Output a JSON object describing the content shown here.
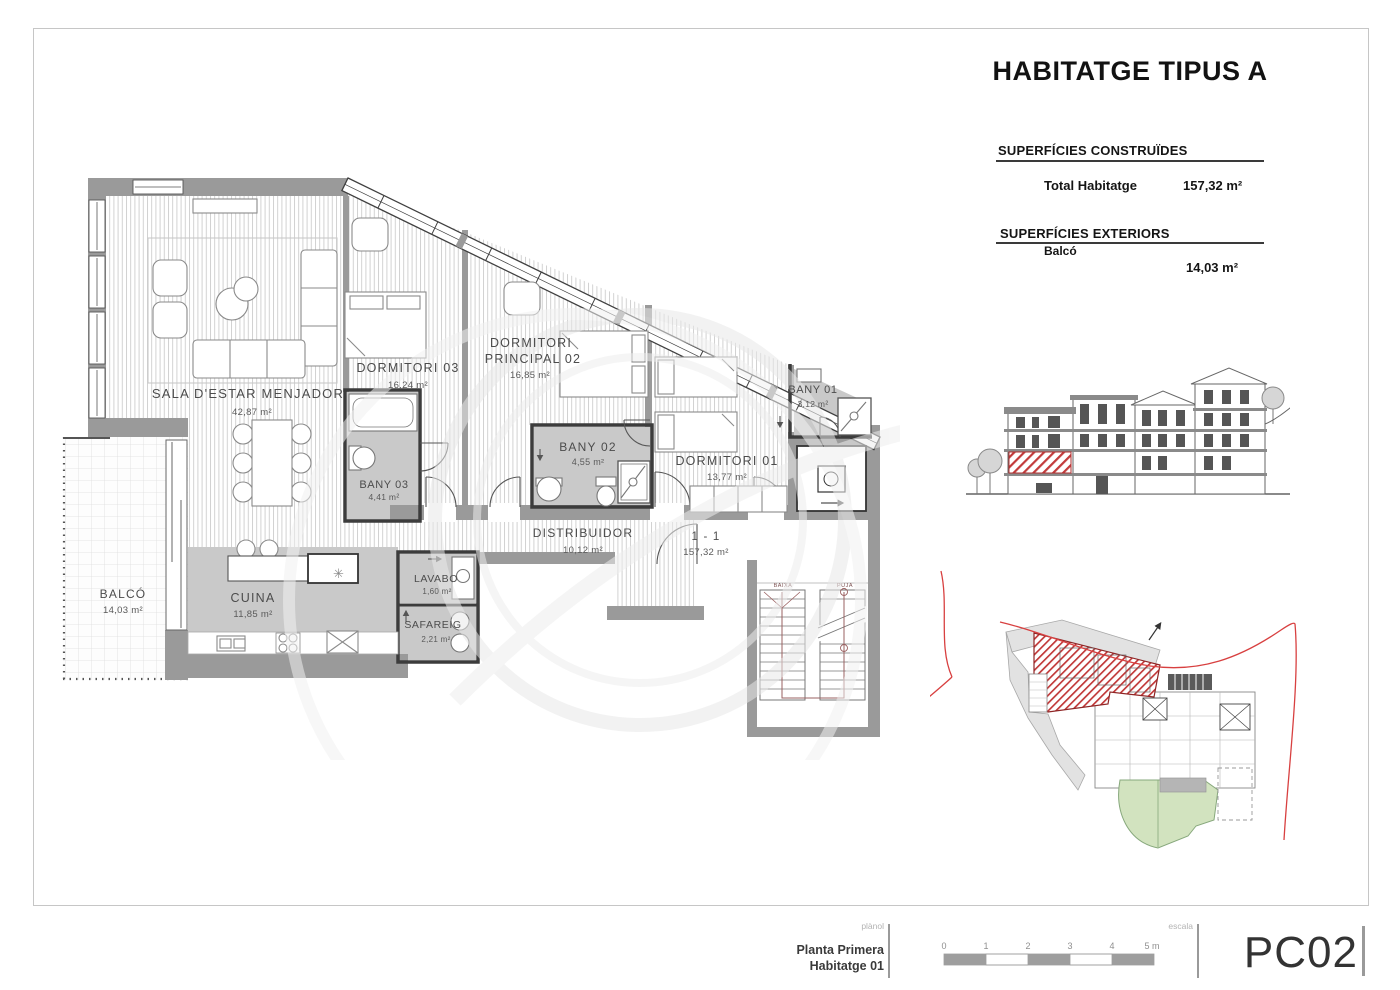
{
  "sheet": {
    "title": "HABITATGE TIPUS A",
    "surfaces_built": {
      "heading": "SUPERFÍCIES CONSTRUÏDES",
      "label": "Total Habitatge",
      "value": "157,32 m²"
    },
    "surfaces_ext": {
      "heading": "SUPERFÍCIES EXTERIORS",
      "label": "Balcó",
      "value": "14,03 m²"
    }
  },
  "plan": {
    "rooms": {
      "sala": {
        "name": "SALA D'ESTAR MENJADOR",
        "area": "42,87 m²"
      },
      "dorm03": {
        "name": "DORMITORI 03",
        "area": "16,24 m²"
      },
      "dormp": {
        "line1": "DORMITORI",
        "line2": "PRINCIPAL 02",
        "area": "16,85 m²"
      },
      "bany01": {
        "name": "BANY 01",
        "area": "3,12 m²"
      },
      "bany02": {
        "name": "BANY 02",
        "area": "4,55 m²"
      },
      "bany03": {
        "name": "BANY 03",
        "area": "4,41 m²"
      },
      "dorm01": {
        "name": "DORMITORI 01",
        "area": "13,77 m²"
      },
      "distribuidor": {
        "name": "DISTRIBUIDOR",
        "area": "10,12 m²"
      },
      "cuina": {
        "name": "CUINA",
        "area": "11,85 m²"
      },
      "balco": {
        "name": "BALCÓ",
        "area": "14,03 m²"
      },
      "lavabo": {
        "name": "LAVABO",
        "area": "1,60 m²"
      },
      "safareig": {
        "name": "SAFAREIG",
        "area": "2,21 m²"
      }
    },
    "section_mark": {
      "label": "1 - 1",
      "area": "157,32 m²"
    },
    "stairs": {
      "down": "BAIXA",
      "up": "PUJA"
    }
  },
  "titleblock": {
    "plan_tag": "plànol",
    "plan_name_line1": "Planta Primera",
    "plan_name_line2": "Habitatge 01",
    "scale_tag": "escala",
    "scale_ticks": [
      "0",
      "1",
      "2",
      "3",
      "4",
      "5 m"
    ],
    "sheet_code": "PC02"
  },
  "colors": {
    "wall_gray": "#9a9a9a",
    "wet_floor_gray": "#c9c9c9",
    "plank_hatch": "#cdcdcd",
    "unit_red": "#c03535",
    "garden_green": "#d2e3bf",
    "boundary_red": "#d84040"
  }
}
